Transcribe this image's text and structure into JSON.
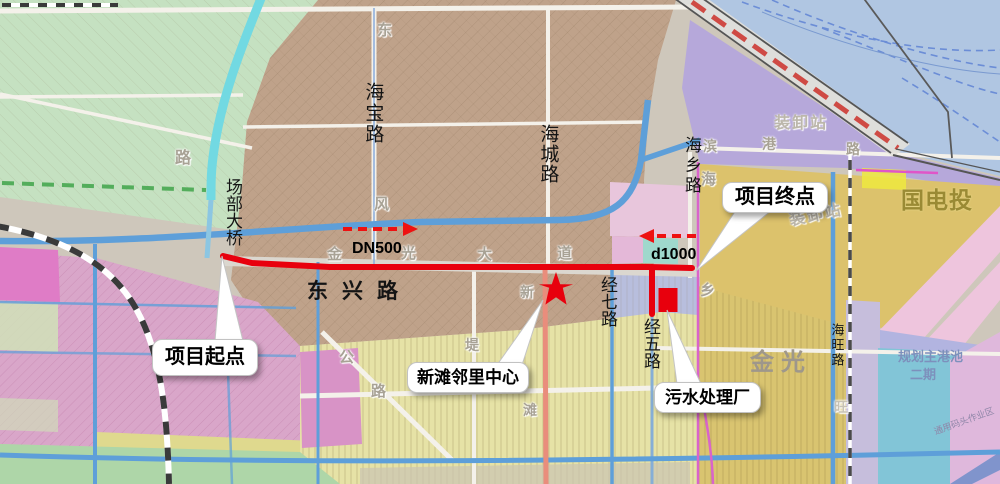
{
  "annotations": {
    "project_start": "项目起点",
    "project_end": "项目终点",
    "neighborhood_center": "新滩邻里中心",
    "sewage_plant": "污水处理厂",
    "pipe_dn500": "DN500",
    "pipe_d1000": "d1000"
  },
  "roads": {
    "haibao_road": "海宝路",
    "haicheng_road": "海城路",
    "haixiang_road": "海乡路",
    "dongxing_road": "东兴路",
    "jingqi_road": "经七路",
    "jingwu_road": "经五路",
    "haiwang_road": "海旺路",
    "changbu_bridge": "场部大桥"
  },
  "areas": {
    "jinguang": "金光",
    "guodiantou": "国电投",
    "loading_station_top": "装卸站",
    "loading_station_bottom": "装卸站",
    "planned_harbor_basin": "规划主港池",
    "planned_harbor_phase": "二期",
    "wharf_work_area": "通用码头作业区"
  },
  "background_labels": {
    "dong": "东",
    "feng": "风",
    "lu_west": "路",
    "jin": "金",
    "guang": "光",
    "da": "大",
    "dao": "道",
    "gong": "公",
    "lu_south": "路",
    "xin": "新",
    "tan": "滩",
    "di": "堤",
    "bin": "滨",
    "gang": "港",
    "lu_bingang": "路",
    "hai": "海",
    "xiang": "乡",
    "wang": "旺"
  },
  "colors": {
    "route_red": "#e8000d",
    "arrow_red": "#ee1111",
    "water_blue": "#b0c6e2",
    "green_area": "#c5e1c1",
    "brown_area": "#bfa28a",
    "lavender_area": "#b6a8da",
    "yellow_area": "#dcc26c",
    "pink_area": "#d9a6c9",
    "callout_bg": "#ffffff"
  }
}
